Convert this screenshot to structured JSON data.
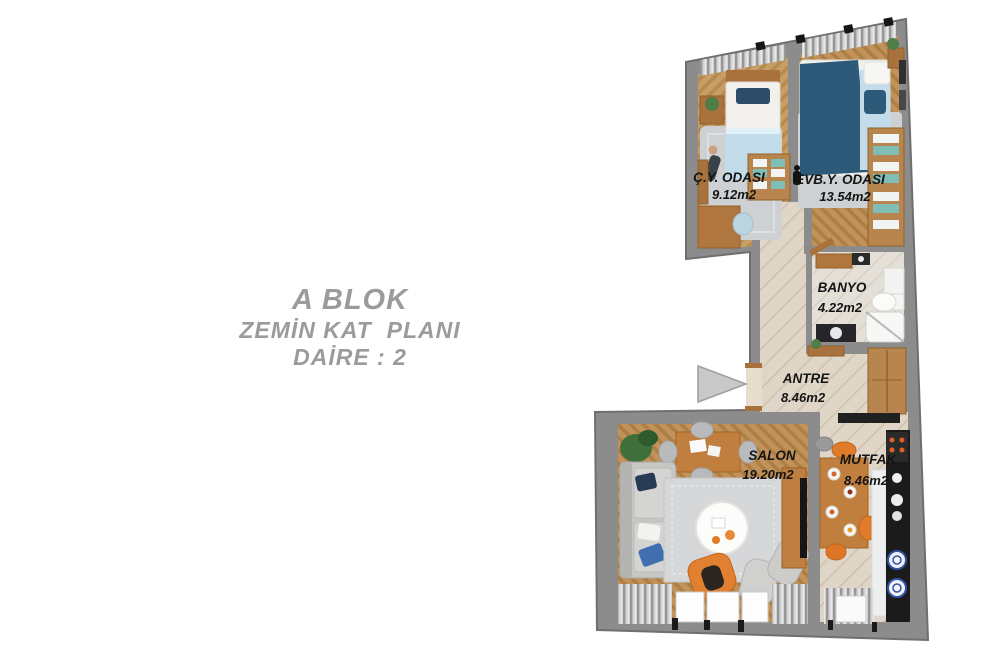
{
  "title": {
    "line1": "A BLOK",
    "line2": "ZEMİN KAT  PLANI",
    "line3": "DAİRE : 2"
  },
  "rooms": [
    {
      "id": "cy-odasi",
      "name": "Ç.Y. ODASI",
      "area": "9.12m2"
    },
    {
      "id": "evby-odasi",
      "name": "EVB.Y. ODASI",
      "area": "13.54m2"
    },
    {
      "id": "banyo",
      "name": "BANYO",
      "area": "4.22m2"
    },
    {
      "id": "antre",
      "name": "ANTRE",
      "area": "8.46m2"
    },
    {
      "id": "salon",
      "name": "SALON",
      "area": "19.20m2"
    },
    {
      "id": "mutfak",
      "name": "MUTFAK",
      "area": "8.46m2"
    }
  ],
  "colors": {
    "wall": "#8c8c8c",
    "wall_edge": "#6f6f6f",
    "floor_parquet": "#c79e66",
    "floor_plank": "#e0d6c8",
    "accent_orange": "#e07b2a",
    "bed_blue_dark": "#2c5a78",
    "bed_blue_light": "#c3dcec",
    "sofa_gray": "#c6c6c4",
    "counter_black": "#1b1b1b",
    "label_color": "#141414",
    "title_color": "#9b9b9b",
    "arrow_fill": "#c9c9c9"
  }
}
